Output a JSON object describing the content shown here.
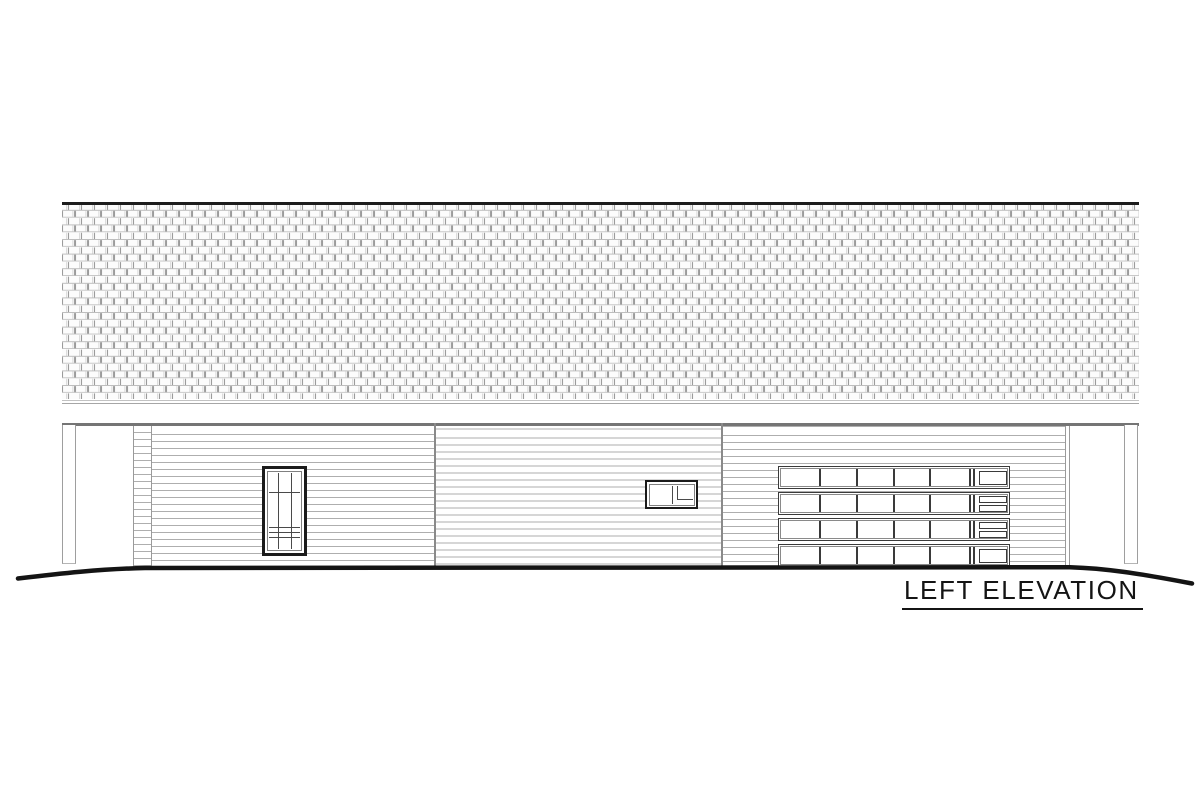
{
  "title": {
    "label": "LEFT ELEVATION"
  },
  "colors": {
    "ink": "#141414",
    "frame_dark": "#1b1b1b",
    "joint_gray": "#8a8a8a",
    "siding_line": "#aeaeae",
    "shingle_line": "#9b9b9b",
    "band_gray": "#757575"
  },
  "building": {
    "roof": {
      "material": "shingles"
    },
    "walls": {
      "material": "horizontal-lap-siding",
      "sections": 3
    },
    "posts": 2,
    "left_window": {
      "vertical_muntins": 2,
      "horizontal_muntin": 1,
      "sash_rails": 3
    },
    "small_window": {
      "panes": 2
    },
    "garage_door": {
      "rows": 4,
      "panel_columns": 6,
      "insets_per_row": [
        1,
        2,
        2,
        1
      ],
      "dividers_x": [
        40,
        77,
        114,
        150
      ],
      "double_line_x": [
        190,
        194
      ]
    }
  }
}
